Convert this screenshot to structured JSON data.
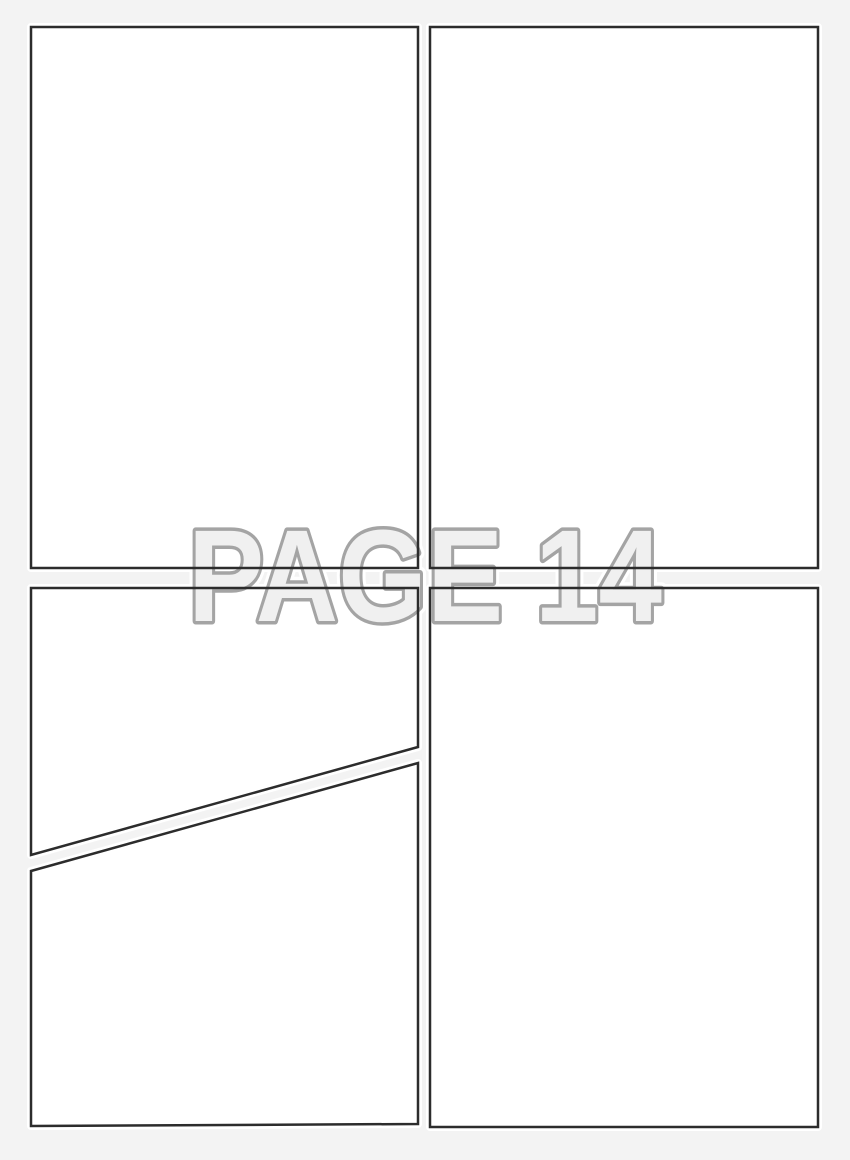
{
  "page": {
    "watermark_text": "PAGE 14"
  },
  "panels": [
    {
      "id": "panel-1",
      "position": "top-left",
      "shape": "rectangle"
    },
    {
      "id": "panel-2",
      "position": "top-right",
      "shape": "rectangle"
    },
    {
      "id": "panel-3",
      "position": "middle-left-above-diagonal",
      "shape": "diagonal-cut"
    },
    {
      "id": "panel-4",
      "position": "bottom-left-below-diagonal",
      "shape": "diagonal-cut"
    },
    {
      "id": "panel-5",
      "position": "bottom-right",
      "shape": "rectangle"
    }
  ],
  "colors": {
    "page_background": "#f3f3f3",
    "panel_fill": "#ffffff",
    "panel_halo": "#ffffff",
    "panel_border": "#2c2c2c",
    "watermark_fill": "#f0f0f0",
    "watermark_outline": "#a4a4a4",
    "watermark_halo": "#ffffff"
  }
}
